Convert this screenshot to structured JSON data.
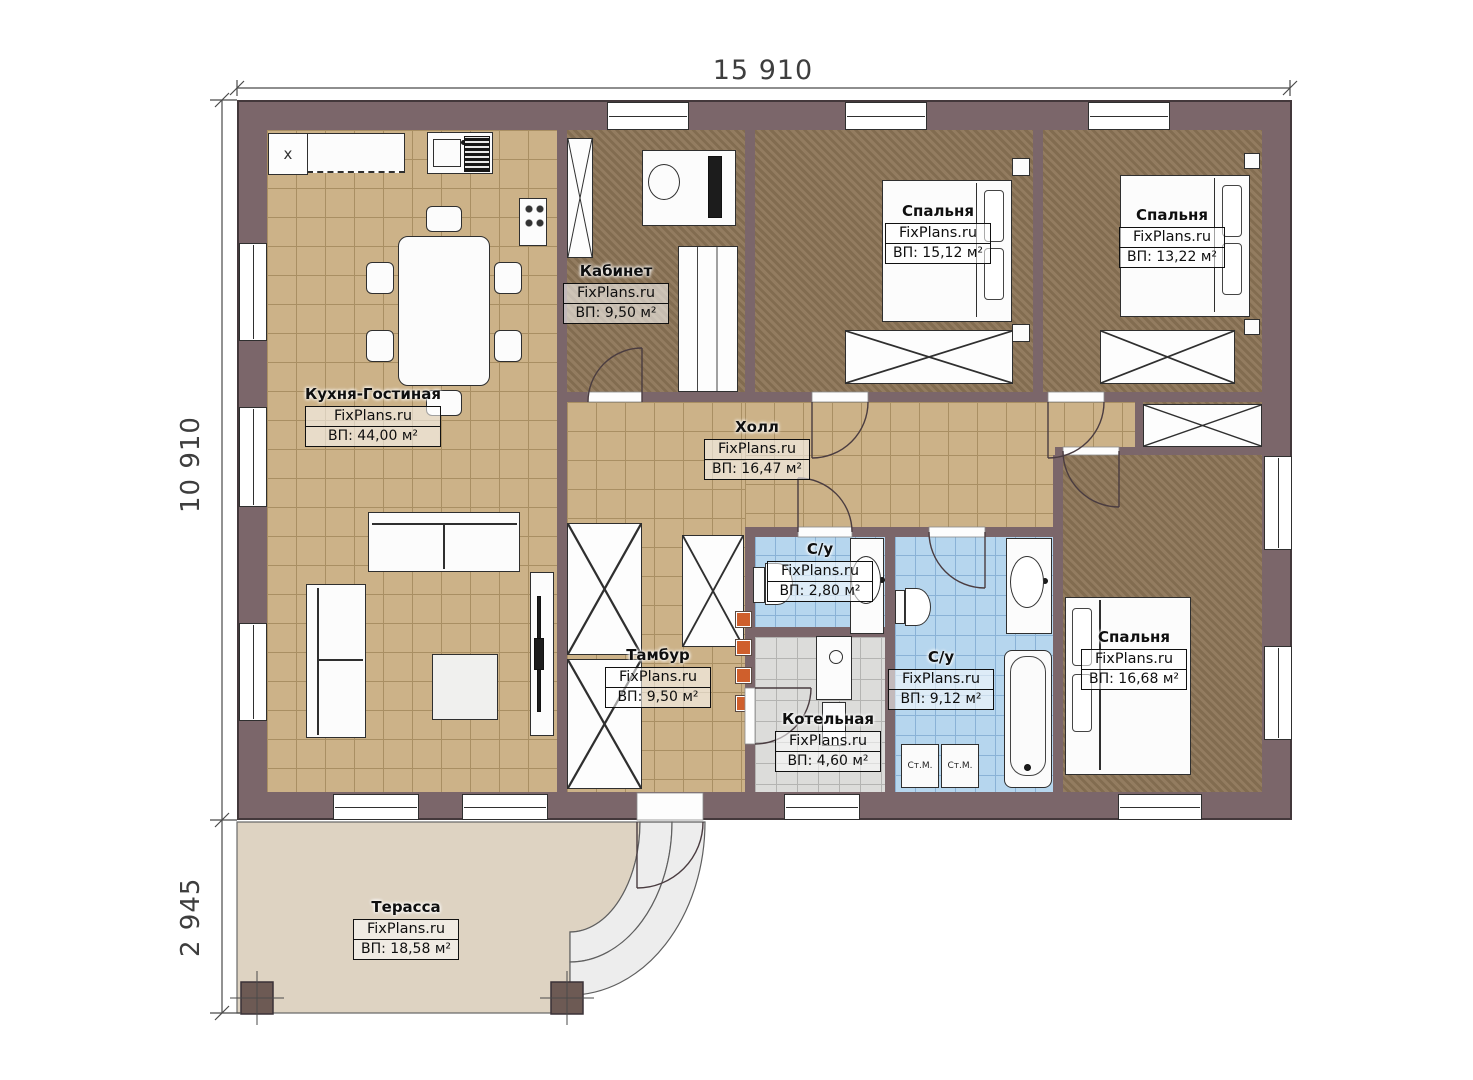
{
  "plan": {
    "brand": "FixPlans.ru",
    "dimensions": {
      "width_top": "15 910",
      "height_left": "10 910",
      "terrace_depth": "2 945"
    },
    "rooms": {
      "kitchen_living": {
        "name": "Кухня-Гостиная",
        "area": "ВП: 44,00 м²"
      },
      "kabinet": {
        "name": "Кабинет",
        "area": "ВП: 9,50 м²"
      },
      "bedroom1": {
        "name": "Спальня",
        "area": "ВП: 15,12 м²"
      },
      "bedroom2": {
        "name": "Спальня",
        "area": "ВП: 13,22 м²"
      },
      "hall": {
        "name": "Холл",
        "area": "ВП: 16,47 м²"
      },
      "bathroom_small": {
        "name": "С/у",
        "area": "ВП: 2,80 м²"
      },
      "bathroom_big": {
        "name": "С/у",
        "area": "ВП: 9,12 м²"
      },
      "bedroom3": {
        "name": "Спальня",
        "area": "ВП: 16,68 м²"
      },
      "tambur": {
        "name": "Тамбур",
        "area": "ВП: 9,50 м²"
      },
      "kotelnaya": {
        "name": "Котельная",
        "area": "ВП: 4,60 м²"
      },
      "terrace": {
        "name": "Терасса",
        "area": "ВП: 18,58 м²"
      }
    },
    "labels": {
      "washer": "Ст.М.",
      "corner_mark": "x"
    },
    "colors": {
      "wall": "#7b666a",
      "tile_tan": "#ccb288",
      "carpet": "#8c7456",
      "tile_blue": "#b6d6ee",
      "tile_gray": "#dcdcda",
      "terrace": "#ded3c2",
      "accent_orange": "#cf5f2c"
    }
  }
}
